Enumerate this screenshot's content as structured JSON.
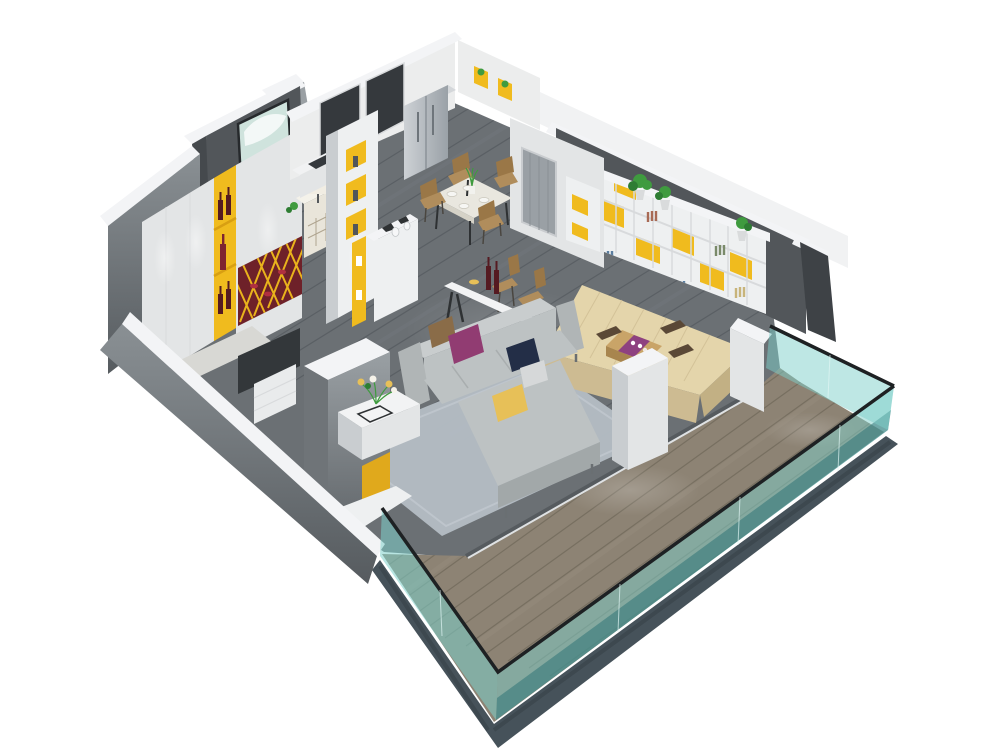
{
  "meta": {
    "canvas_width": 1000,
    "canvas_height": 750,
    "background": "#ffffff",
    "view": "isometric cutaway 3D rendering of a furnished apartment"
  },
  "palette": {
    "white": "#ffffff",
    "capWhite": "#f3f4f6",
    "capSide": "#dfe1e3",
    "wallWhite": "#eceded",
    "wallBright": "#f1f2f3",
    "wallLight": "#e3e5e6",
    "wallMid": "#c9cdd0",
    "wallGray": "#9aa0a4",
    "wallGrayDark": "#6f7478",
    "wallSlate": "#52565a",
    "wallSlateDark": "#45494d",
    "wallCharcoal": "#3e4246",
    "windowDark": "#35393d",
    "floorWood": "#6b7074",
    "floorPlank": "#565b60",
    "floorStreak": "#82878c",
    "rug": "#b4bcc4",
    "rugEdge": "#c3cad1",
    "balconyWood": "#8d8374",
    "balconyPlank": "#6e6659",
    "balconyStreak": "#aaa192",
    "stone": "#46525a",
    "stoneDark": "#333d43",
    "curb": "#dfe2e4",
    "curbShadow": "#565b5f",
    "glassTeal": "#7ed0ca",
    "glassDeep": "#2f7577",
    "glassRail": "#1e2123",
    "glassSeam": "#dff5f3",
    "yellow": "#f0bb1e",
    "yellowDeep": "#e0a91c",
    "gold": "#d89f12",
    "latticeYellow": "#e9b31c",
    "shelfWhite": "#eef0f1",
    "shelfLine": "#d8dadc",
    "plantGreen": "#3f9b3f",
    "plantDark": "#2e7d33",
    "potGray": "#d9dbdc",
    "sofaLight": "#c9cdce",
    "sofaMid": "#bdc2c3",
    "sofaDark": "#a9aeaf",
    "sofaDeep": "#a2a8a9",
    "armGray": "#b0b5b6",
    "pillowBrown": "#8a6c48",
    "pillowPurple": "#913c72",
    "pillowNavy": "#232e47",
    "pillowYellow": "#e7c058",
    "pillowGray": "#d6d8d9",
    "platformWood": "#e4d5ab",
    "platformSide": "#cdbb92",
    "platformEdge": "#c2b084",
    "tableWood": "#c9a468",
    "tableWoodDark": "#a8854e",
    "runner": "#8e4180",
    "cushionBrown": "#5a4836",
    "tableWhite": "#f2f3f4",
    "tableCream": "#e9e7df",
    "tableCreamEdge": "#d5d2c7",
    "chairTan": "#b08d5c",
    "chairTanDark": "#9a7747",
    "steelTop": "#d4d7da",
    "steelHandle": "#6e757b",
    "doorGray": "#9aa0a5",
    "doorFrame": "#c9cccf",
    "doorGrain": "#8a9095",
    "wineRed": "#6e2129",
    "bottleDark": "#551a21",
    "bottleWine": "#7e2430",
    "wineDot": "#b03040",
    "paintingSky": "#cfe3dd",
    "paintingField": "#c2b14a",
    "paintingFrame": "#26292c",
    "lampShade": "#f1ede3",
    "sideboard": "#e9e5da",
    "sideboardTop": "#f4f2ea",
    "slotLine": "#b0a590",
    "black": "#2e3133",
    "drawerWhite": "#e9ebec",
    "darkOpening": "#33373a",
    "stepLight": "#d8d8d4",
    "bookRust": "#a86a55",
    "bookBlue": "#5b7ea0",
    "bookSand": "#c8b47a",
    "bookOlive": "#7a8a6a"
  },
  "scene": {
    "type": "3d-floorplan-cutaway",
    "rooms": [
      "kitchen",
      "dining-area",
      "hallway",
      "living-room",
      "tatami-lounge",
      "bedroom-corner",
      "balcony"
    ],
    "objects": [
      "dark-wood-plank-floor",
      "gray-area-rug",
      "sectional-sofa",
      "throw-pillows",
      "white-coffee-table",
      "flower-vase",
      "bar-counter",
      "wine-bottles",
      "bar-stools",
      "dining-table",
      "dining-chairs",
      "refrigerator",
      "kitchen-counter",
      "yellow-accent-bookshelf",
      "potted-plants",
      "wine-lattice-rack",
      "wine-display-niche",
      "abstract-painting",
      "table-lamp",
      "sideboard",
      "tatami-platform",
      "low-tea-table",
      "floor-cushions",
      "interior-door",
      "glass-balcony-railing",
      "balcony-deck",
      "partition-wall-yellow-stripe",
      "white-pillars",
      "display-cabinet"
    ]
  }
}
